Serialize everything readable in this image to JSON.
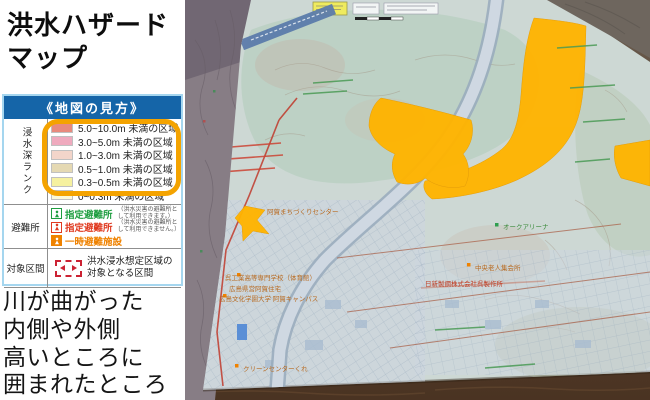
{
  "panel": {
    "title": {
      "line1": "洪水ハザード",
      "line2": "マップ"
    },
    "legend": {
      "header": "《地図の見方》",
      "depth": {
        "section_label": "浸水深ランク",
        "highlight_color": "#f4a300",
        "rows": [
          {
            "color": "#e88a7d",
            "label": "5.0~10.0m 未満の区域"
          },
          {
            "color": "#efaabe",
            "label": "3.0~5.0m 未満の区域"
          },
          {
            "color": "#f3d5ca",
            "label": "1.0~3.0m 未満の区域"
          },
          {
            "color": "#e5d9b3",
            "label": "0.5~1.0m 未満の区域"
          },
          {
            "color": "#f6f1a0",
            "label": "0.3~0.5m 未満の区域"
          },
          {
            "color": "#fbf8d8",
            "label": "0~0.3m 未満の区域"
          }
        ]
      },
      "shelter": {
        "section_label": "避難所",
        "rows": [
          {
            "label": "指定避難所",
            "color": "#1f9e40",
            "note": "（洪水災害の避難所として利用できます。）"
          },
          {
            "label": "指定避難所",
            "color": "#e03a20",
            "note": "（洪水災害の避難所として利用できません。）"
          },
          {
            "label": "一時避難施設",
            "color": "#ef8200",
            "note": ""
          }
        ]
      },
      "target": {
        "section_label": "対象区間",
        "note": "洪水浸水想定区域の対象となる区間"
      }
    },
    "caption_lines": [
      "川が曲がった",
      "内側や外側",
      "高いところに",
      "囲まれたところ"
    ]
  },
  "map_photo": {
    "flood_color": "#ffb400",
    "labels": [
      {
        "text": "阿賀まちづくりセンター",
        "color": "#b86a20"
      },
      {
        "text": "呉工業高等専門学校（体育館）",
        "color": "#b86a20"
      },
      {
        "text": "広島県営阿賀住宅",
        "color": "#b86a20"
      },
      {
        "text": "広島文化学園大学 阿賀キャンパス",
        "color": "#b86a20"
      },
      {
        "text": "クリーンセンターくれ",
        "color": "#b86a20"
      },
      {
        "text": "オークアリーナ",
        "color": "#3a8a3a"
      },
      {
        "text": "日新製鋼株式会社呉製作所",
        "color": "#c03a20"
      },
      {
        "text": "中央老人集会所",
        "color": "#b86a20"
      }
    ]
  }
}
